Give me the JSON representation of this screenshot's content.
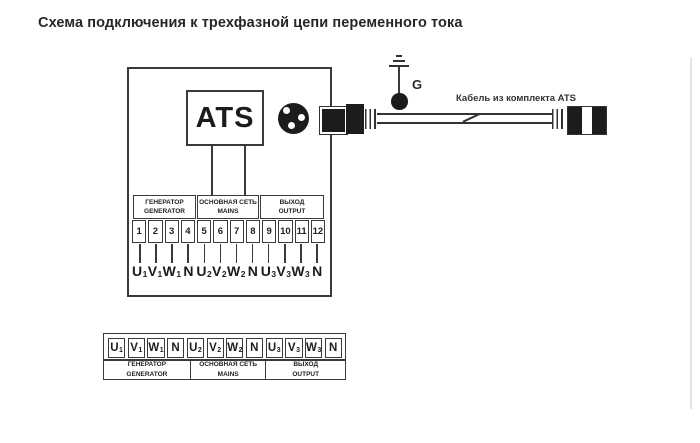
{
  "title": "Схема подключения к трехфазной цепи переменного тока",
  "colors": {
    "ink": "#3a3a3a",
    "fill": "#1c1c1c",
    "background": "#ffffff"
  },
  "diagram": {
    "ats_label": "ATS",
    "ground_label": "G",
    "cable_label": "Кабель из комплекта ATS",
    "sections": [
      {
        "ru": "ГЕНЕРАТОР",
        "en": "GENERATOR"
      },
      {
        "ru": "ОСНОВНАЯ СЕТЬ",
        "en": "MAINS"
      },
      {
        "ru": "ВЫХОД",
        "en": "OUTPUT"
      }
    ],
    "terminal_numbers": [
      "1",
      "2",
      "3",
      "4",
      "5",
      "6",
      "7",
      "8",
      "9",
      "10",
      "11",
      "12"
    ],
    "terminals": [
      {
        "base": "U",
        "sub": "1"
      },
      {
        "base": "V",
        "sub": "1"
      },
      {
        "base": "W",
        "sub": "1"
      },
      {
        "base": "N",
        "sub": ""
      },
      {
        "base": "U",
        "sub": "2"
      },
      {
        "base": "V",
        "sub": "2"
      },
      {
        "base": "W",
        "sub": "2"
      },
      {
        "base": "N",
        "sub": ""
      },
      {
        "base": "U",
        "sub": "3"
      },
      {
        "base": "V",
        "sub": "3"
      },
      {
        "base": "W",
        "sub": "3"
      },
      {
        "base": "N",
        "sub": ""
      }
    ]
  },
  "legend_table": {
    "cells": [
      {
        "base": "U",
        "sub": "1"
      },
      {
        "base": "V",
        "sub": "1"
      },
      {
        "base": "W",
        "sub": "1"
      },
      {
        "base": "N",
        "sub": ""
      },
      {
        "base": "U",
        "sub": "2"
      },
      {
        "base": "V",
        "sub": "2"
      },
      {
        "base": "W",
        "sub": "2"
      },
      {
        "base": "N",
        "sub": ""
      },
      {
        "base": "U",
        "sub": "3"
      },
      {
        "base": "V",
        "sub": "3"
      },
      {
        "base": "W",
        "sub": "3"
      },
      {
        "base": "N",
        "sub": ""
      }
    ],
    "sections": [
      {
        "ru": "ГЕНЕРАТОР",
        "en": "GENERATOR"
      },
      {
        "ru": "ОСНОВНАЯ СЕТЬ",
        "en": "MAINS"
      },
      {
        "ru": "ВЫХОД",
        "en": "OUTPUT"
      }
    ]
  }
}
